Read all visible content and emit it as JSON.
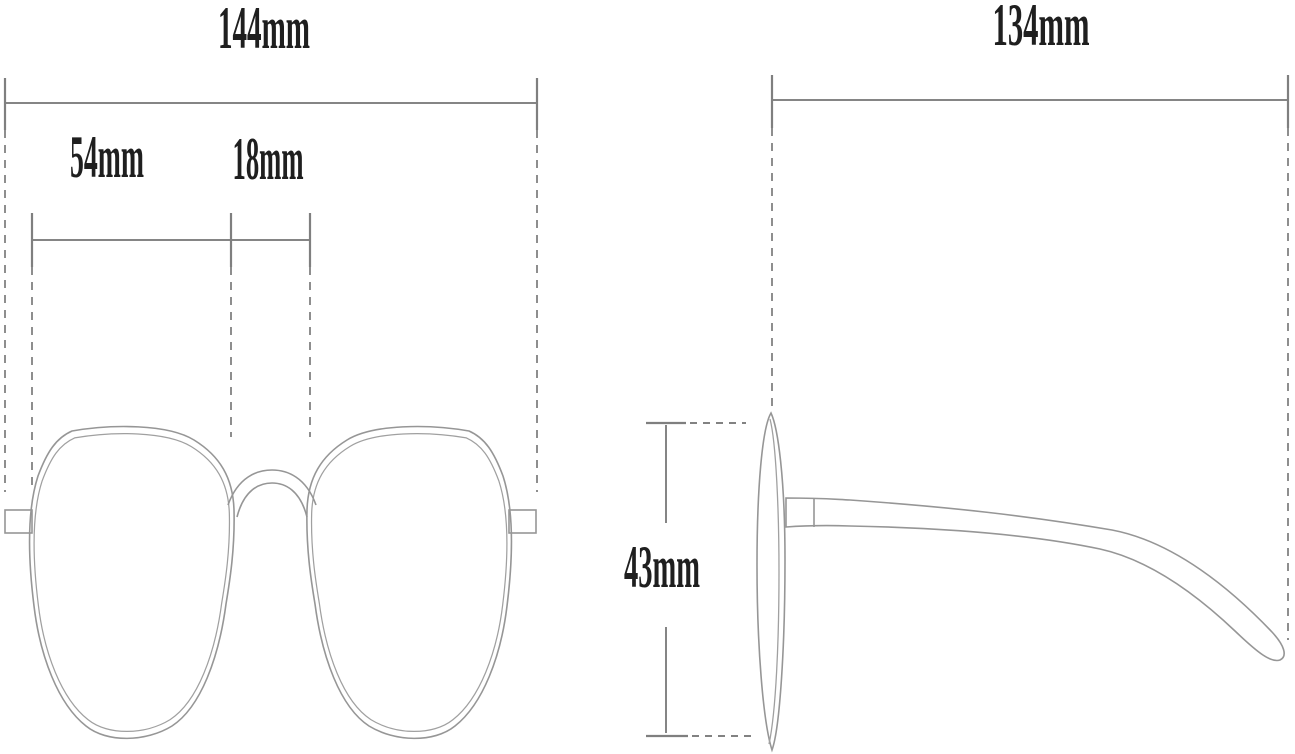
{
  "diagram": {
    "type": "eyeglasses-dimension-diagram",
    "background": "#ffffff",
    "line_color": "#969696",
    "dimension_line_color": "#858585",
    "text_color": "#1f1f1f",
    "front_view": {
      "total_width_label": "144mm",
      "lens_width_label": "54mm",
      "bridge_width_label": "18mm"
    },
    "side_view": {
      "temple_length_label": "134mm",
      "lens_height_label": "43mm"
    },
    "measurements": [
      {
        "name": "frame-total-width",
        "value": 144,
        "unit": "mm"
      },
      {
        "name": "lens-width",
        "value": 54,
        "unit": "mm"
      },
      {
        "name": "bridge-width",
        "value": 18,
        "unit": "mm"
      },
      {
        "name": "temple-arm-length",
        "value": 134,
        "unit": "mm"
      },
      {
        "name": "lens-height",
        "value": 43,
        "unit": "mm"
      }
    ]
  }
}
